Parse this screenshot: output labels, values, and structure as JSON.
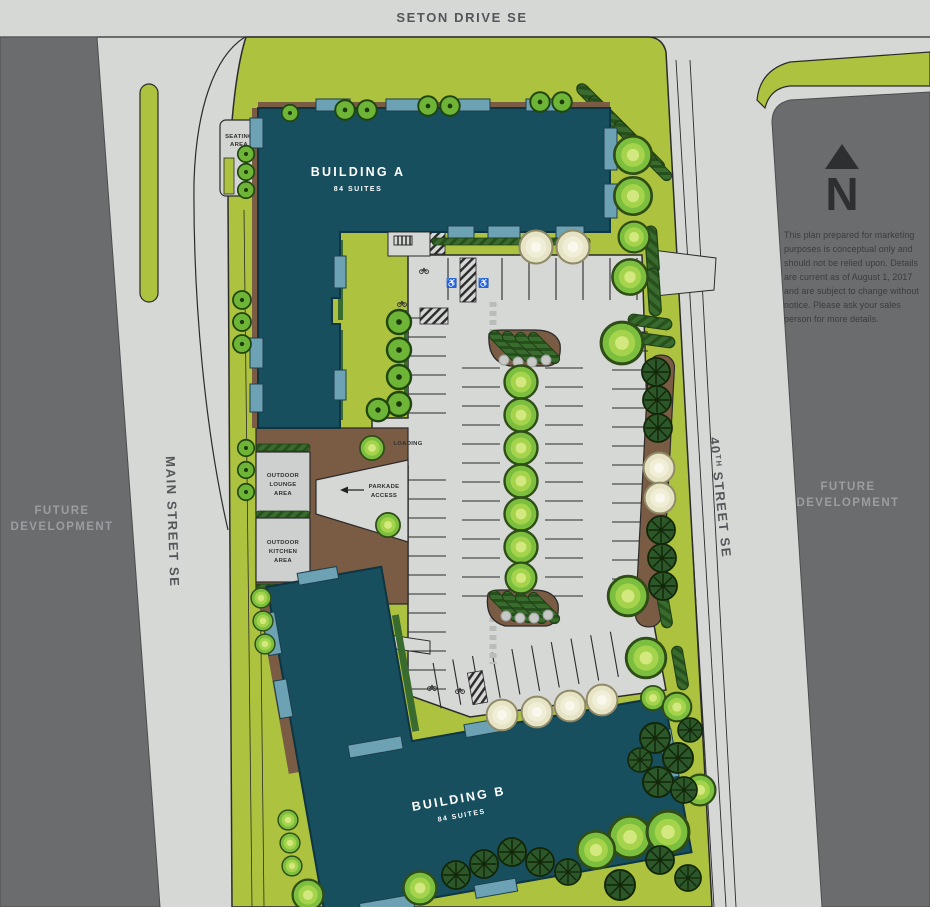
{
  "streets": {
    "seton": "SETON DRIVE SE",
    "main": "MAIN STREET SE",
    "fortieth_num": "40",
    "fortieth_sup": "TH",
    "fortieth_rest": "STREET SE"
  },
  "parcels": {
    "left_line1": "FUTURE",
    "left_line2": "DEVELOPMENT",
    "right_line1": "FUTURE",
    "right_line2": "DEVELOPMENT"
  },
  "buildings": {
    "a_name": "BUILDING A",
    "a_suites": "84 SUITES",
    "b_name": "BUILDING B",
    "b_suites": "84 SUITES"
  },
  "areas": {
    "seating_1": "SEATING",
    "seating_2": "AREA",
    "lounge_1": "OUTDOOR",
    "lounge_2": "LOUNGE",
    "lounge_3": "AREA",
    "kitchen_1": "OUTDOOR",
    "kitchen_2": "KITCHEN",
    "kitchen_3": "AREA",
    "loading": "LOADING",
    "parkade_1": "PARKADE",
    "parkade_2": "ACCESS"
  },
  "north": "N",
  "icons": {
    "accessible": "♿"
  },
  "disclaimer": [
    "This plan prepared for marketing",
    "purposes is conceptual only and",
    "should not be relied upon. Details",
    "are current as of August 1, 2017",
    "and are subject to change without",
    "notice. Please ask your sales",
    "person for more details."
  ],
  "colors": {
    "street": "#d6d8d6",
    "parcel_dark": "#6b6c6e",
    "site_green": "#adc23e",
    "hedge_green": "#3a6b2e",
    "building_teal": "#174f5e",
    "patio_blue": "#6ca2b4",
    "deck_brown": "#7a5c44",
    "tree_green": "#7cbe3e",
    "conifer_green": "#2c572a",
    "cream_tree": "#e7e3c5",
    "outline": "#2b2b2b",
    "street_label": "#55565a",
    "future_label": "#9b9da0"
  }
}
